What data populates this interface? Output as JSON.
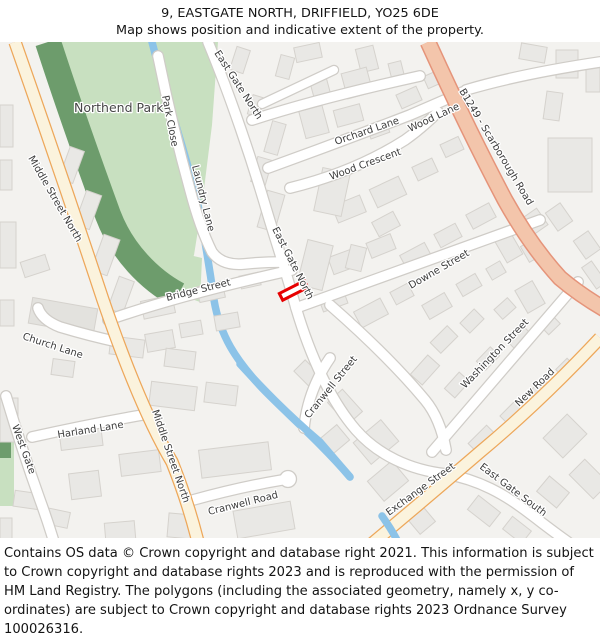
{
  "header": {
    "title": "9, EASTGATE NORTH, DRIFFIELD, YO25 6DE",
    "subtitle": "Map shows position and indicative extent of the property."
  },
  "map": {
    "place_labels": {
      "park": "Northend Park"
    },
    "streets": {
      "middle_street_north_top": "Middle Street North",
      "middle_street_north_bottom": "Middle Street North",
      "park_close": "Park Close",
      "laundry_lane": "Laundry Lane",
      "east_gate_north_top": "East Gate North",
      "east_gate_north_mid": "East Gate North",
      "orchard_lane": "Orchard Lane",
      "wood_crescent": "Wood Crescent",
      "wood_lane": "Wood Lane",
      "b1249": "B1249 - Scarborough Road",
      "bridge_street": "Bridge Street",
      "downe_street": "Downe Street",
      "washington_street": "Washington Street",
      "new_road": "New Road",
      "church_lane": "Church Lane",
      "west_gate": "West Gate",
      "harland_lane": "Harland Lane",
      "cranwell_street": "Cranwell Street",
      "cranwell_road": "Cranwell Road",
      "exchange_street": "Exchange Street",
      "east_gate_south": "East Gate South"
    },
    "marker": {
      "description": "indicative extent of property at 9 Eastgate North",
      "color": "#e60000"
    },
    "colors": {
      "background": "#f3f2ef",
      "building_fill": "#e9e8e5",
      "building_stroke": "#d5d2cd",
      "road_fill": "#ffffff",
      "road_casing": "#cfccc7",
      "primary_road_fill": "#fbf3dd",
      "primary_road_casing": "#eda75a",
      "b_road_fill": "#f3c5ab",
      "b_road_casing": "#e5947a",
      "park_green": "#c8e0c0",
      "wood_green": "#6d9c6c",
      "water_blue": "#8cc3e8",
      "label_color": "#3c3c3c"
    }
  },
  "footer": {
    "text": "Contains OS data © Crown copyright and database right 2021. This information is subject to Crown copyright and database rights 2023 and is reproduced with the permission of HM Land Registry. The polygons (including the associated geometry, namely x, y co-ordinates) are subject to Crown copyright and database rights 2023 Ordnance Survey 100026316."
  }
}
